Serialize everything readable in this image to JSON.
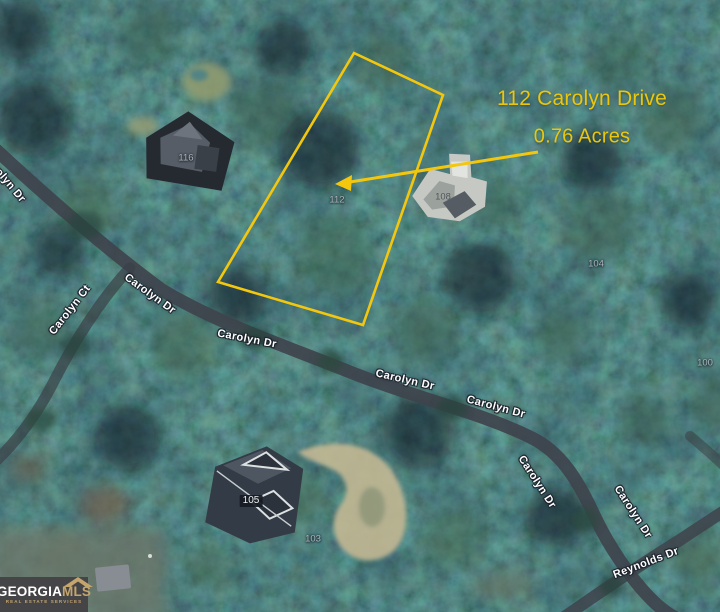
{
  "annotation": {
    "address": "112 Carolyn Drive",
    "acreage": "0.76 Acres",
    "highlight_color": "#F2C70E"
  },
  "streets": [
    "Carolyn Dr",
    "Carolyn Ct",
    "Carolyn Dr",
    "Carolyn Dr",
    "Carolyn Dr",
    "Carolyn Dr",
    "Carolyn Dr",
    "Carolyn Dr",
    "Reynolds Dr"
  ],
  "parcels": [
    "116",
    "112",
    "108",
    "104",
    "100",
    "105",
    "103"
  ],
  "logo": {
    "brand_primary": "GEORGIA",
    "brand_secondary": "MLS",
    "tagline": "REAL ESTATE SERVICES"
  },
  "colors": {
    "road": "#3E434B",
    "street_label": "#FFFFFF",
    "parcel_label": "#AEB6BD",
    "logo_background": "#454548",
    "logo_gold": "#C5A56C"
  }
}
